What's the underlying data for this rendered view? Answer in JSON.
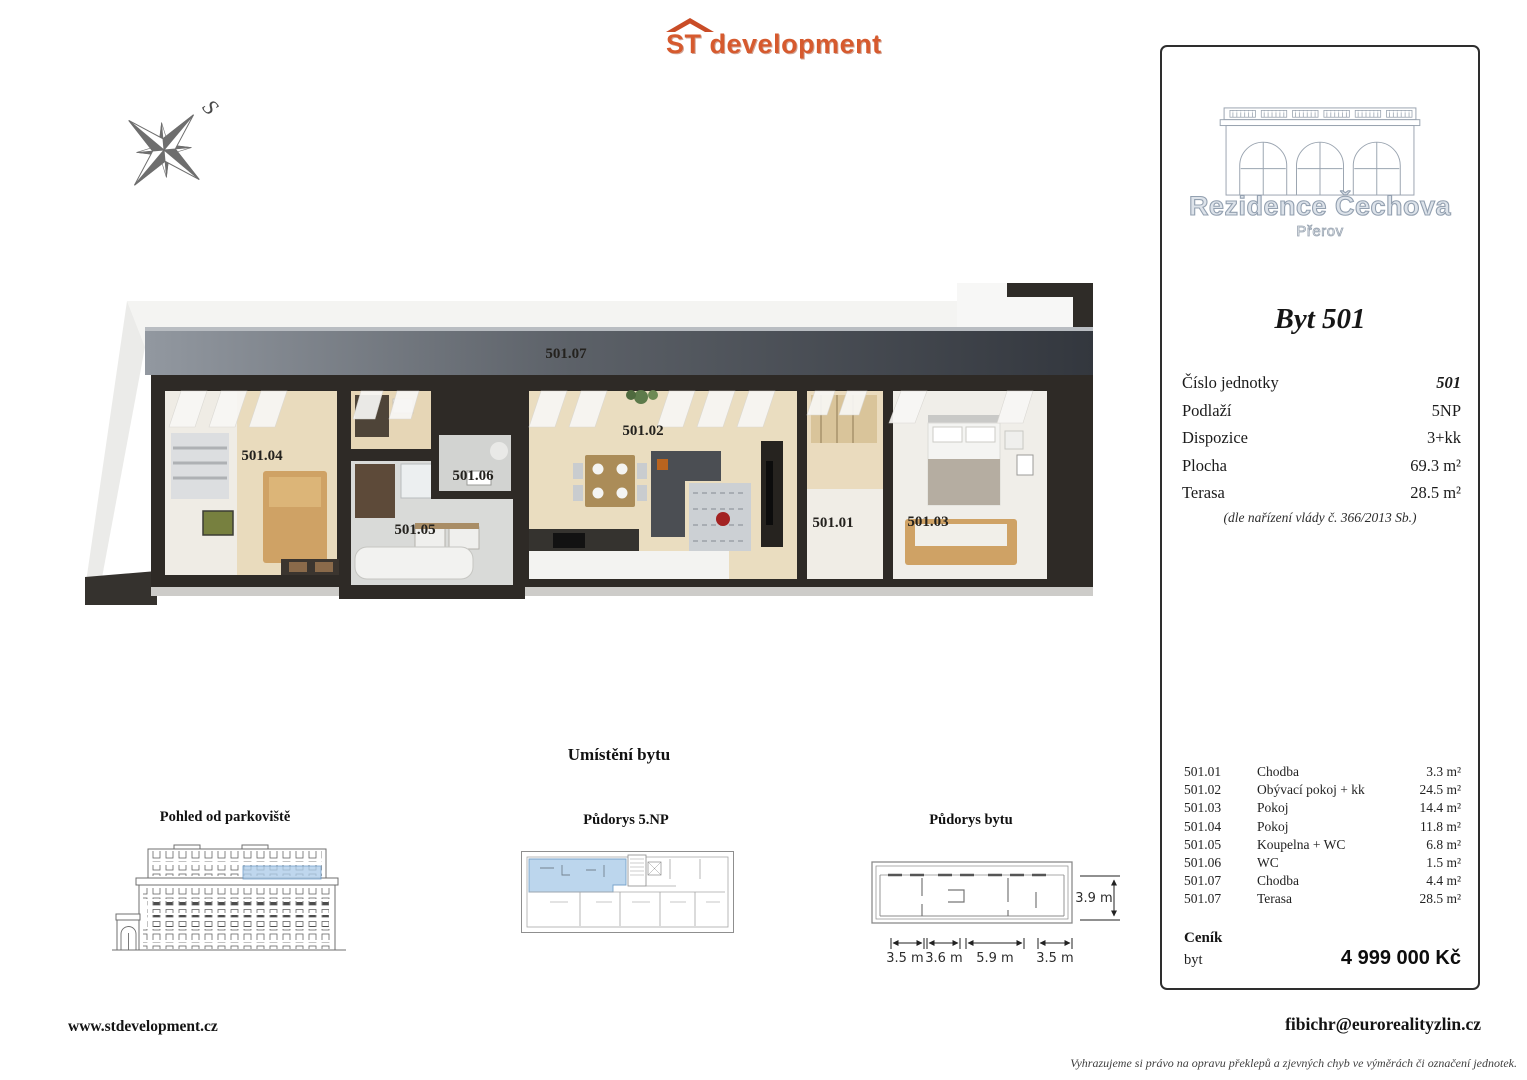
{
  "logo": {
    "st": "ST",
    "rest": "development"
  },
  "compass": {
    "north_label": "S"
  },
  "plan3d": {
    "labels": {
      "terasa07": "501.07",
      "pokoj04": "501.04",
      "wc06": "501.06",
      "koupelna05": "501.05",
      "obyvaci02": "501.02",
      "chodba01": "501.01",
      "pokoj03": "501.03"
    }
  },
  "location": {
    "title": "Umístění bytu",
    "view_title": "Pohled od parkoviště",
    "floor_title": "Půdorys 5.NP",
    "unit_title": "Půdorys bytu",
    "dims": {
      "w1": "3.5 m",
      "w2": "3.6 m",
      "w3": "5.9 m",
      "w4": "3.5 m",
      "h": "3.9 m"
    }
  },
  "panel": {
    "project": "Rezidence Čechova",
    "city": "Přerov",
    "unit": "Byt 501",
    "details": [
      {
        "label": "Číslo jednotky",
        "value": "501"
      },
      {
        "label": "Podlaží",
        "value": "5NP"
      },
      {
        "label": "Dispozice",
        "value": "3+kk"
      },
      {
        "label": "Plocha",
        "value": "69.3 m²"
      },
      {
        "label": "Terasa",
        "value": "28.5 m²"
      }
    ],
    "note": "(dle nařízení vlády č. 366/2013 Sb.)",
    "rooms": [
      {
        "code": "501.01",
        "name": "Chodba",
        "area": "3.3 m²"
      },
      {
        "code": "501.02",
        "name": "Obývací pokoj + kk",
        "area": "24.5 m²"
      },
      {
        "code": "501.03",
        "name": "Pokoj",
        "area": "14.4 m²"
      },
      {
        "code": "501.04",
        "name": "Pokoj",
        "area": "11.8 m²"
      },
      {
        "code": "501.05",
        "name": "Koupelna + WC",
        "area": "6.8 m²"
      },
      {
        "code": "501.06",
        "name": "WC",
        "area": "1.5 m²"
      },
      {
        "code": "501.07",
        "name": "Chodba",
        "area": "4.4 m²"
      },
      {
        "code": "501.07",
        "name": "Terasa",
        "area": "28.5 m²"
      }
    ],
    "price_title": "Ceník",
    "price_item": "byt",
    "price_value": "4 999 000 Kč"
  },
  "footer": {
    "website": "www.stdevelopment.cz",
    "email": "fibichr@eurorealityzlin.cz",
    "disclaimer": "Vyhrazujeme si právo na opravu překlepů a zjevných chyb ve výměrách či označení jednotek."
  },
  "colors": {
    "accent_orange": "#d65a2e",
    "highlight_blue": "#b7d3ec",
    "terrace_dark": "#4a4e55"
  }
}
